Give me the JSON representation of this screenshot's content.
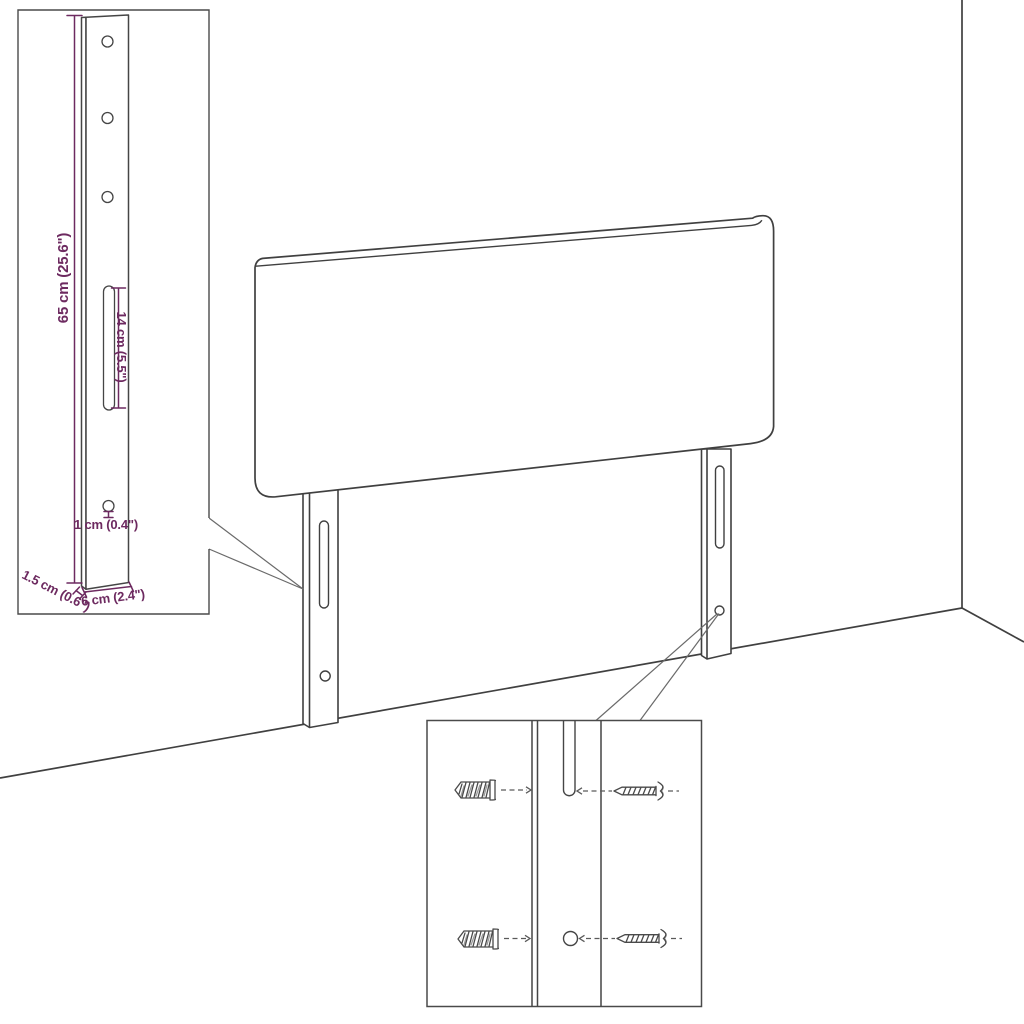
{
  "colors": {
    "line": "#404040",
    "detail": "#4a4a4a",
    "leader": "#5a5a5a",
    "dimension": "#6d2a60"
  },
  "dimensions": {
    "leg_height": "65 cm (25.6\")",
    "slot_length": "14 cm (5.5\")",
    "hole_diameter": "1 cm (0.4\")",
    "leg_thickness": "1.5 cm (0.6\")",
    "leg_width": "6 cm (2.4\")"
  }
}
